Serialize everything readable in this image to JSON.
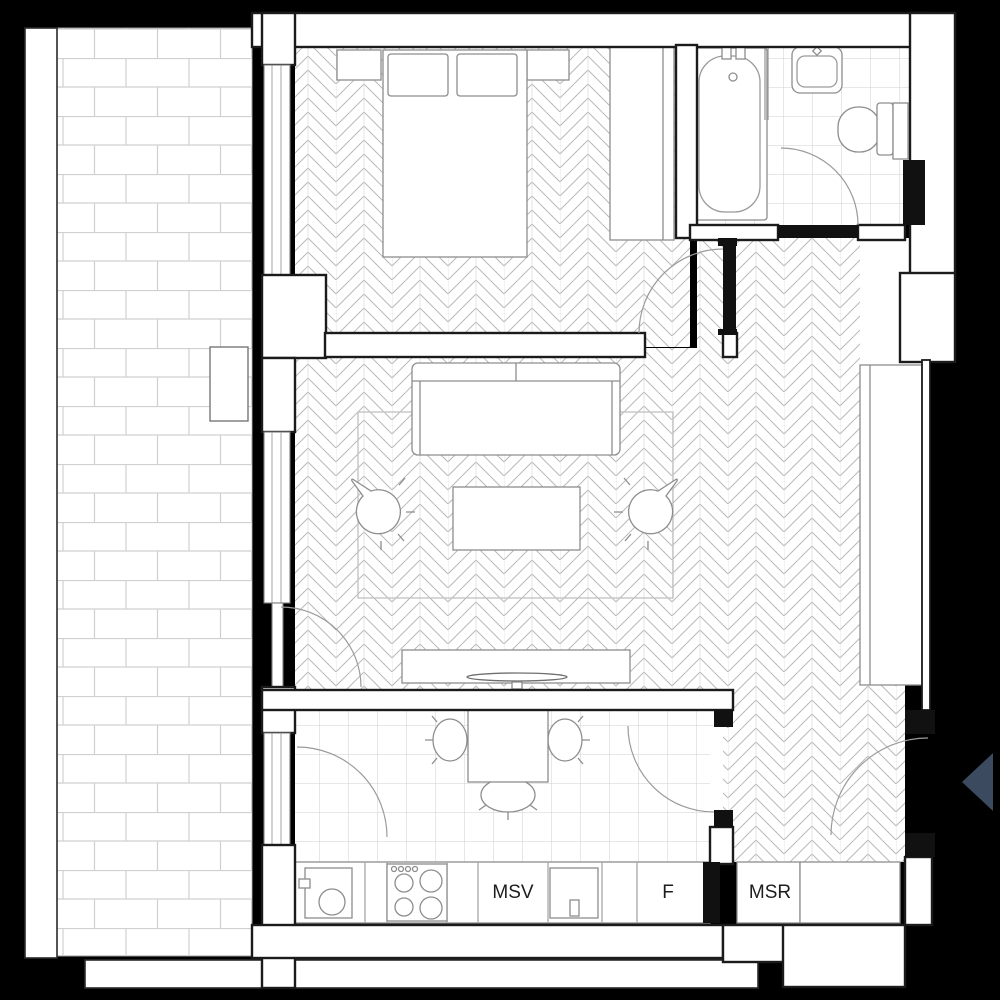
{
  "floorplan": {
    "background_color": "#000000",
    "wall_color": "#1b1b1b",
    "floor_color": "#ffffff",
    "pattern_line_color": "#b9b9b9",
    "furniture_line_color": "#8d8d8d",
    "entrance_arrow_color": "#3b4a5e",
    "kitchen": {
      "cabinet_labels": {
        "msv": "MSV",
        "f": "F"
      }
    },
    "hallway": {
      "cabinet_labels": {
        "msr": "MSR"
      }
    },
    "icons": {
      "entrance_arrow": "left-pointing-triangle"
    }
  }
}
